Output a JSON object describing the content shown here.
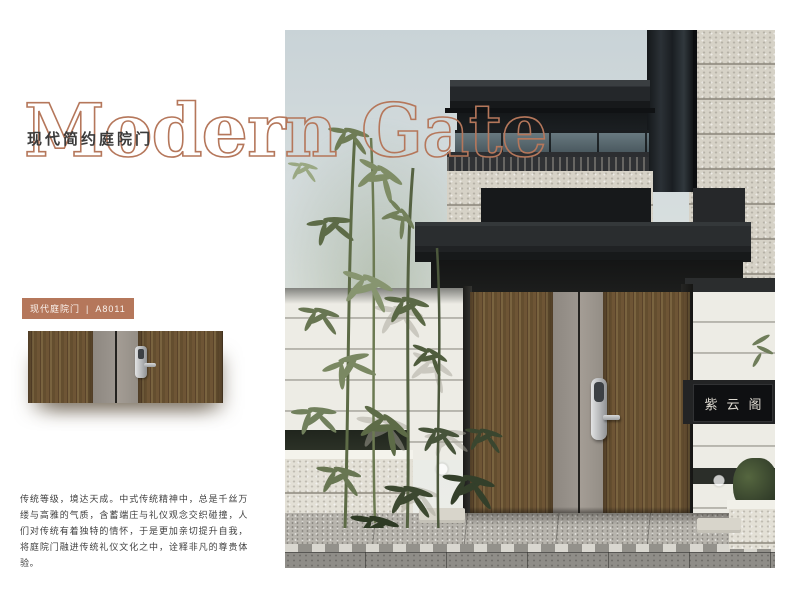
{
  "header": {
    "title": "Modern Gate",
    "subtitle": "现代简约庭院门"
  },
  "product": {
    "badge": {
      "category": "现代庭院门",
      "divider": "|",
      "model": "A8011"
    },
    "description": "传统等级，境达天成。中式传统精神中，总是千丝万缕与高雅的气质，含蓄端庄与礼仪观念交织碰撞，人们对传统有着独特的情怀，于是更加亲切提升自我，将庭院门融进传统礼仪文化之中，诠释非凡的尊贵体验。"
  },
  "photo": {
    "plaque": "紫云阁"
  },
  "colors": {
    "accent": "#b5775b",
    "wood_dark": "#5a432a",
    "wood_mid": "#6e5535",
    "metal_gray": "#9a938c",
    "canopy_dark": "#1c1d1e",
    "wall_white": "#edece5"
  }
}
